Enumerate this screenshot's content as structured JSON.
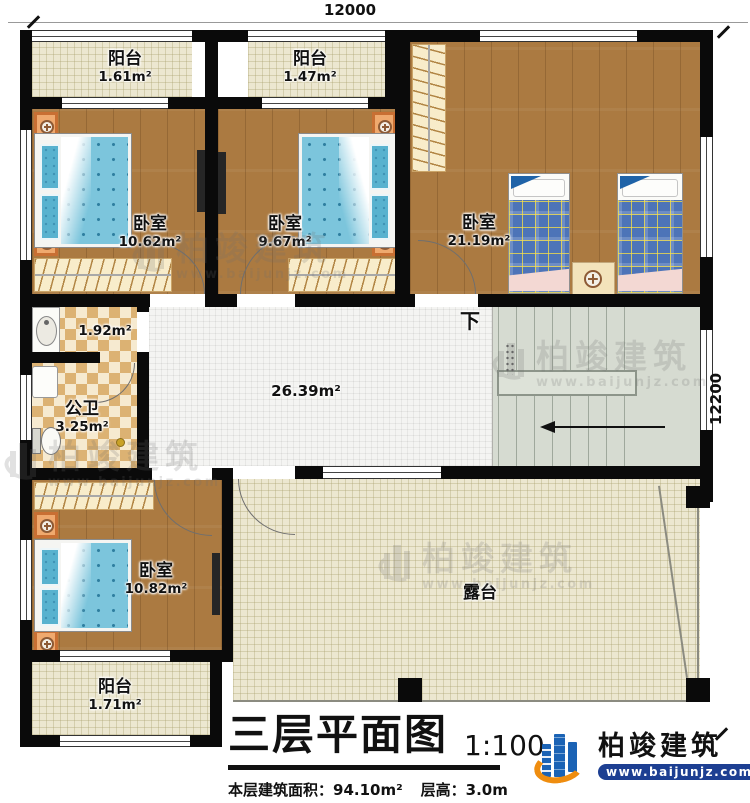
{
  "dimensions": {
    "top": "12000",
    "right": "12200"
  },
  "rooms": {
    "balcony_top_left": {
      "label": "阳台",
      "area": "1.61m²"
    },
    "balcony_top_mid": {
      "label": "阳台",
      "area": "1.47m²"
    },
    "bedroom_top_left": {
      "label": "卧室",
      "area": "10.62m²"
    },
    "bedroom_top_mid": {
      "label": "卧室",
      "area": "9.67m²"
    },
    "bedroom_right": {
      "label": "卧室",
      "area": "21.19m²"
    },
    "wash_area": {
      "area": "1.92m²"
    },
    "bathroom": {
      "label": "公卫",
      "area": "3.25m²"
    },
    "hall": {
      "area": "26.39m²"
    },
    "stairs": {
      "direction_label": "下"
    },
    "bedroom_bottom": {
      "label": "卧室",
      "area": "10.82m²"
    },
    "balcony_bottom": {
      "label": "阳台",
      "area": "1.71m²"
    },
    "terrace": {
      "label": "露台"
    }
  },
  "title_block": {
    "title": "三层平面图",
    "scale": "1:100",
    "floor_area": "本层建筑面积：94.10m²",
    "floor_height": "层高：3.0m"
  },
  "branding": {
    "company": "柏竣建筑",
    "website": "www.baijunjz.com"
  },
  "watermark": {
    "company": "柏竣建筑",
    "website": "www.baijunjz.com"
  },
  "colors": {
    "wall": "#0a0a0a",
    "wood_floor": "#ab7a41",
    "balcony_floor": "#ece7d0",
    "tile_floor": "#f4f4f2",
    "bath_tile": "#dcb273",
    "stair_floor": "#d6dbd1",
    "bed_blue": "#7cc5dc",
    "plaid_blue": "#4d74b8",
    "blanket_pink": "#f3d8d3",
    "nightstand_orange": "#efa96e",
    "brand_blue": "#1b63b5",
    "brand_orange": "#ef8d0f"
  }
}
